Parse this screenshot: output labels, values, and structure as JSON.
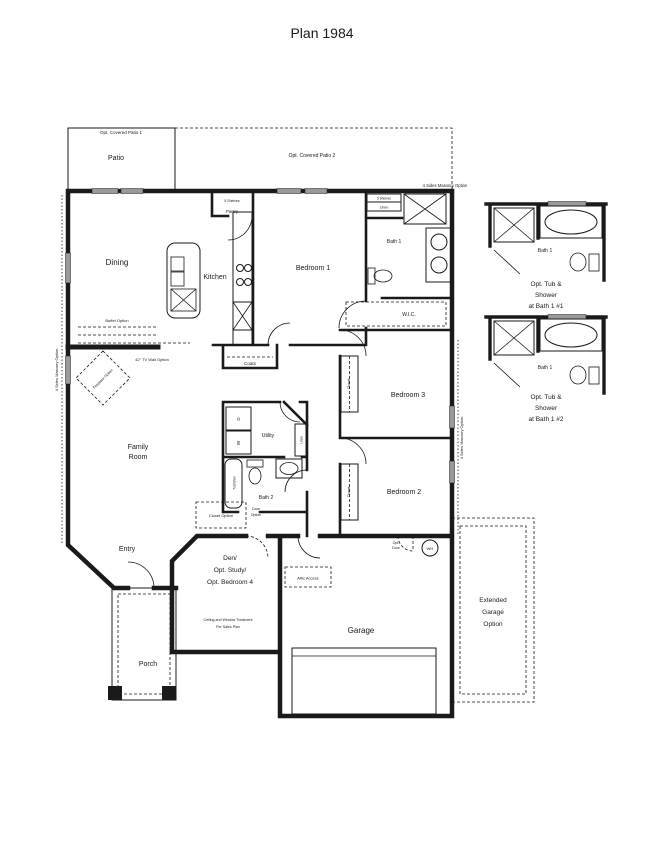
{
  "title": "Plan 1984",
  "colors": {
    "ink": "#1a1a1a",
    "window_gray": "#9a9a9a"
  },
  "patios": {
    "patio1_header": "Opt. Covered Patio 1",
    "patio1_label": "Patio",
    "patio2_label": "Opt. Covered Patio 2"
  },
  "masonry": {
    "top": "4 Sides Masonry Option",
    "left": "4 Sides Masonry Option",
    "right": "4 Sides Masonry Option"
  },
  "rooms": {
    "dining": "Dining",
    "kitchen": "Kitchen",
    "pantry": "Pantry",
    "pantry_shelves": "5 Shelves",
    "bedroom1": "Bedroom 1",
    "bath1": "Bath 1",
    "linen_shelves": "5 Shelves",
    "linen": "Linen",
    "wic": "W.I.C.",
    "bedroom3": "Bedroom 3",
    "bedroom2": "Bedroom 2",
    "family_line1": "Family",
    "family_line2": "Room",
    "utility": "Utility",
    "bath2": "Bath 2",
    "coats": "Coats",
    "entry": "Entry",
    "porch": "Porch",
    "garage": "Garage"
  },
  "closets": {
    "closet3": "Closet",
    "closet2": "Closet",
    "linen2": "Linen",
    "tub_label": "Tub/Shwr"
  },
  "fixtures": {
    "washer": "W",
    "dryer": "D",
    "water_heater": "WH",
    "attic": "Attic Access"
  },
  "options": {
    "buffet": "Buffet Option",
    "tv_wall": "42\" TV Wall Option",
    "fireplace": "Fireplace Option",
    "closet_option": "Closet Option",
    "door_option_line1": "Door",
    "door_option_line2": "Option",
    "opt_door_line1": "Opt.",
    "opt_door_line2": "Door"
  },
  "den": {
    "line1": "Den/",
    "line2": "Opt. Study/",
    "line3": "Opt. Bedroom 4",
    "note1": "Ceiling and Window Treatment",
    "note2": "Per Sales Plan"
  },
  "ext_garage": {
    "line1": "Extended",
    "line2": "Garage",
    "line3": "Option"
  },
  "details": [
    {
      "room": "Bath 1",
      "cap1": "Opt. Tub &",
      "cap2": "Shower",
      "cap3": "at Bath 1 #1"
    },
    {
      "room": "Bath 1",
      "cap1": "Opt. Tub &",
      "cap2": "Shower",
      "cap3": "at Bath 1 #2"
    }
  ]
}
